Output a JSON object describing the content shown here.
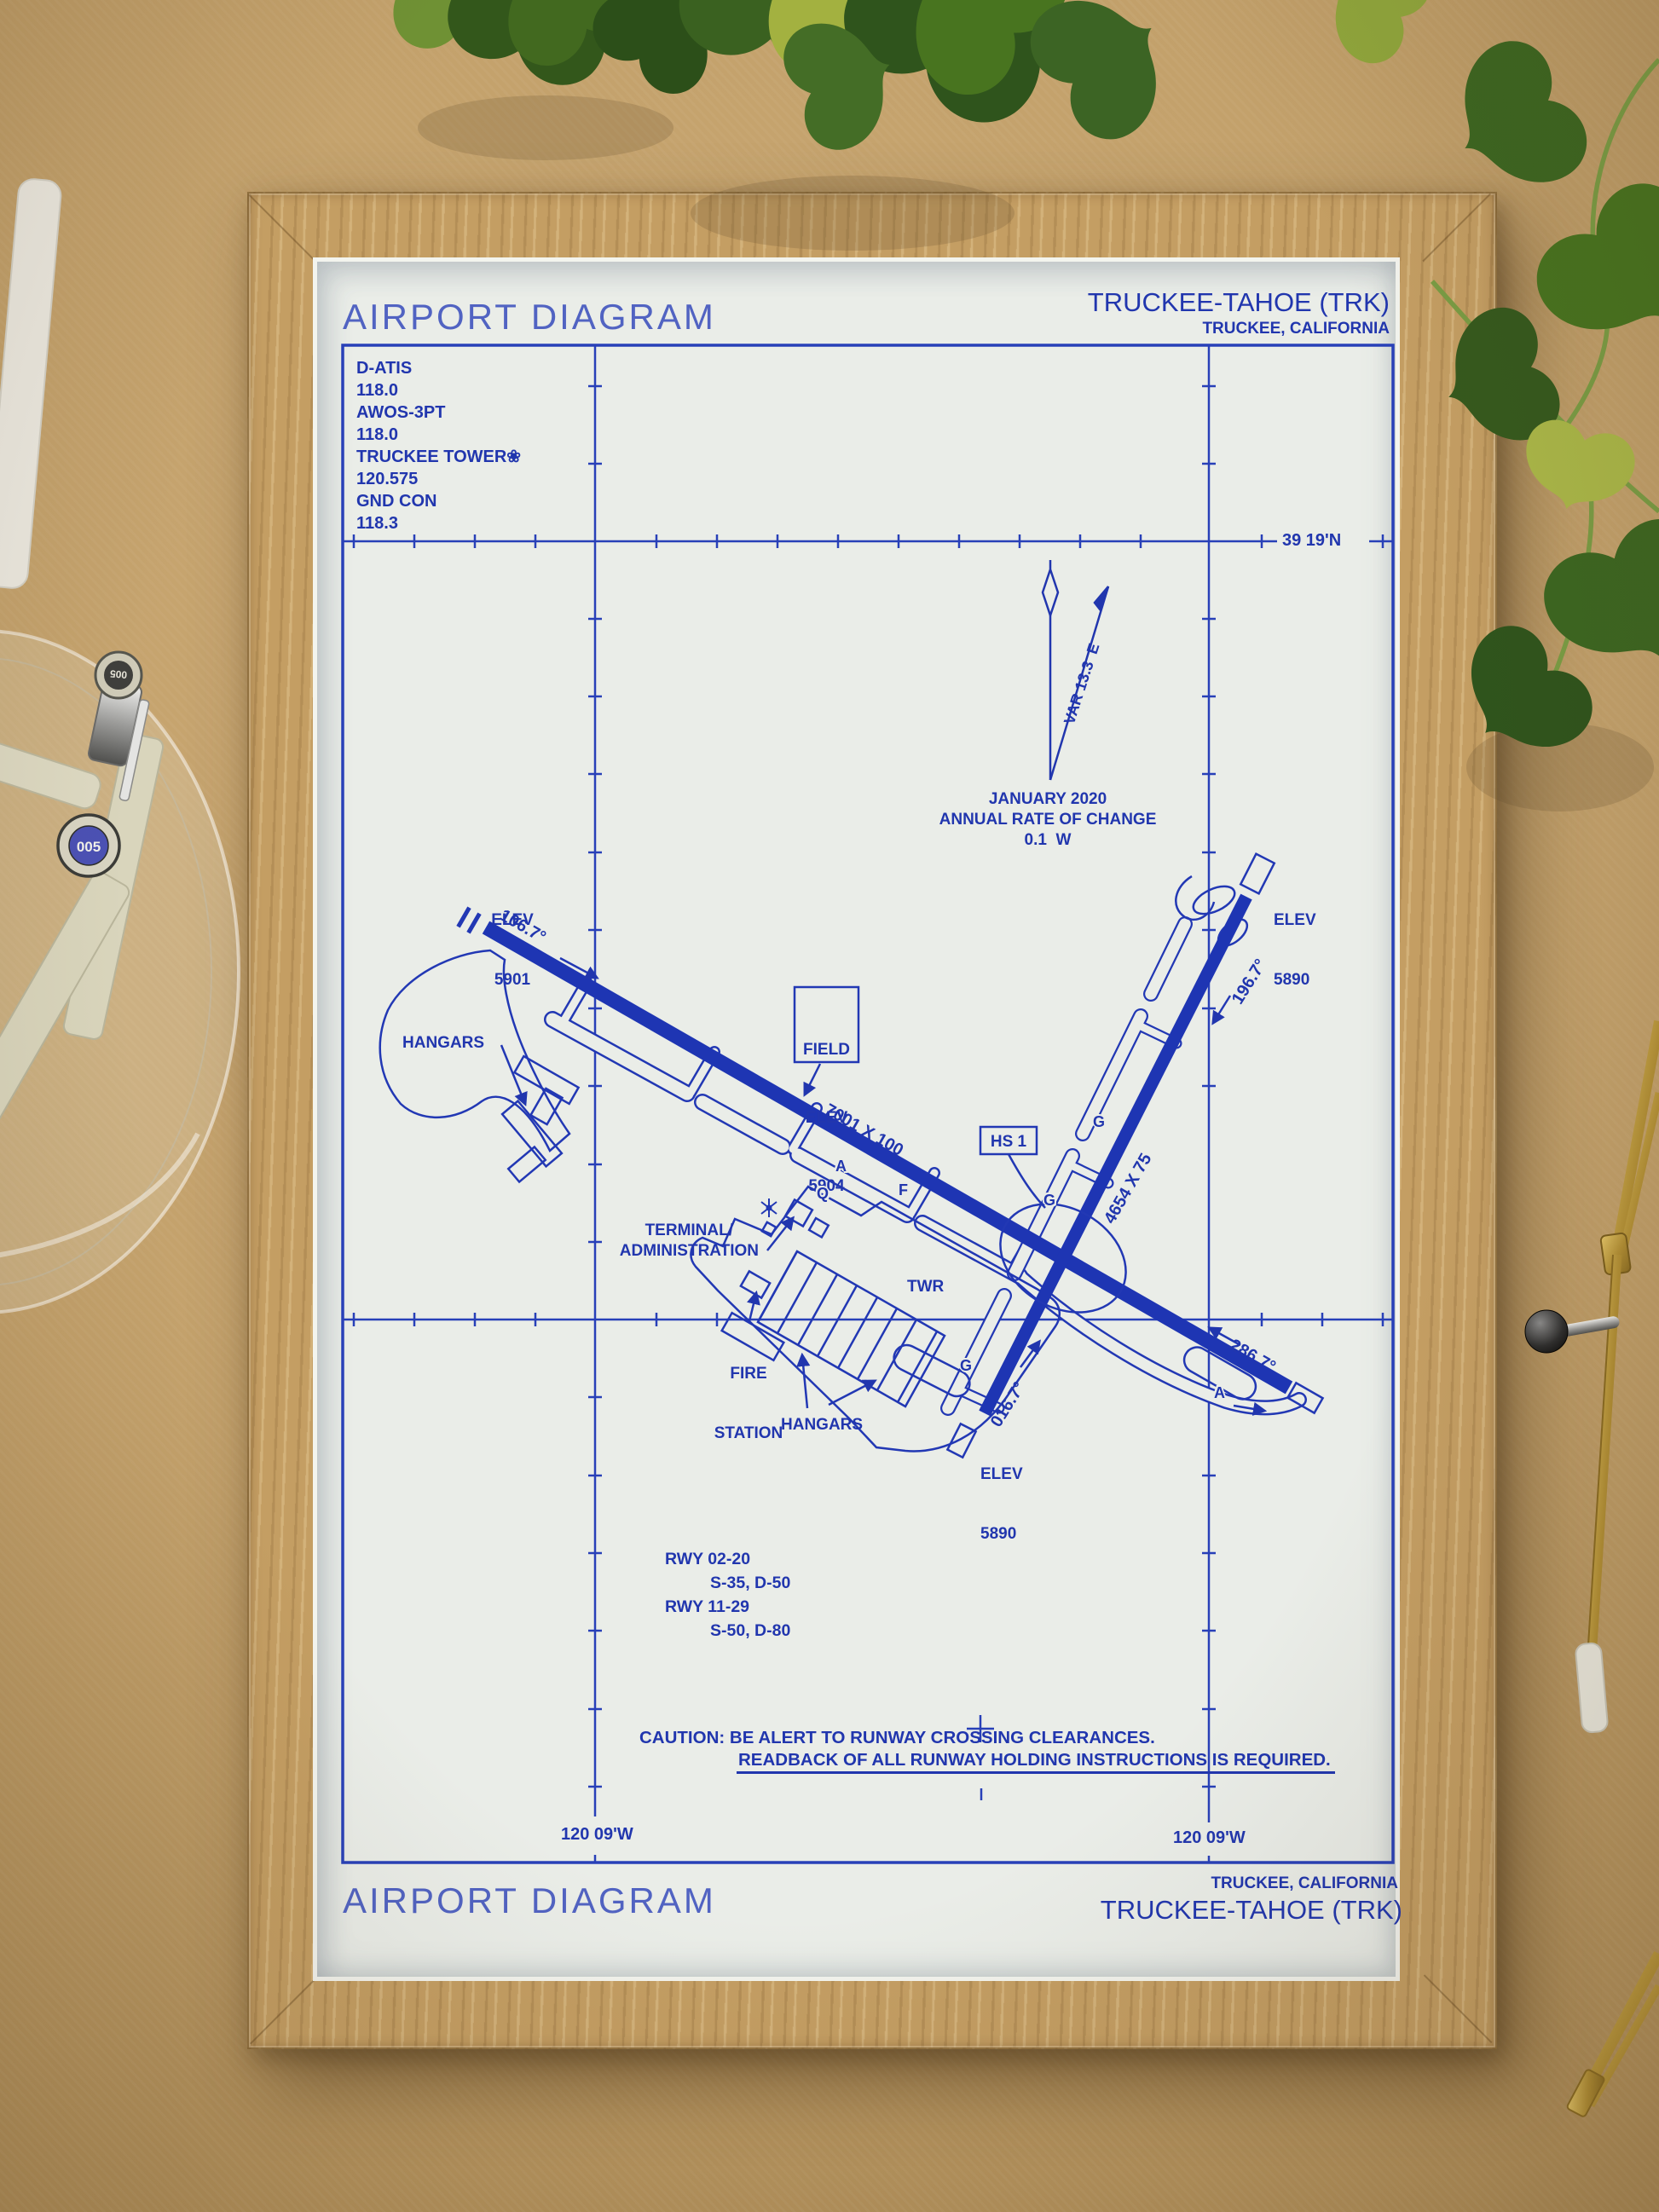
{
  "scene": {
    "colors": {
      "ink": "#2136ae",
      "ink_runway": "#1e35b3",
      "title_ink": "#5163c2",
      "paper": "#eaede8",
      "desk": "#c2a06a",
      "frame_wood": "#c49e63",
      "leaf_green": "#3a6120",
      "brass": "#b28f35"
    }
  },
  "chart": {
    "header": {
      "title": "AIRPORT DIAGRAM",
      "airport_name": "TRUCKEE-TAHOE (TRK)",
      "airport_city": "TRUCKEE, CALIFORNIA"
    },
    "comm_box": {
      "lines": [
        "D-ATIS",
        "118.0",
        "AWOS-3PT",
        "118.0",
        "TRUCKEE TOWER❀",
        "120.575",
        "GND CON",
        "118.3"
      ]
    },
    "graticule": {
      "lat_label": "39 19'N",
      "lon_label_left": "120 09'W",
      "lon_label_right": "120 09'W"
    },
    "north": {
      "var_label": "VAR 13.3  E",
      "note1": "JANUARY 2020",
      "note2": "ANNUAL RATE OF CHANGE",
      "note3": "0.1  W"
    },
    "field_elev": {
      "lines": [
        "FIELD",
        "ELEV",
        "5904"
      ]
    },
    "hot_spot": "HS 1",
    "elevations": {
      "rwy11": [
        "ELEV",
        "5901"
      ],
      "rwy20": [
        "ELEV",
        "5890"
      ],
      "rwy02": [
        "ELEV",
        "5890"
      ]
    },
    "runways": {
      "rwy_11_29": {
        "size_label": "7001 X 100",
        "hdg_11": "106.7°",
        "hdg_29": "286.7°"
      },
      "rwy_02_20": {
        "size_label": "4654 X 75",
        "hdg_02": "016.7°",
        "hdg_20": "196.7°"
      }
    },
    "facilities": {
      "hangars_west": "HANGARS",
      "hangars_south": "HANGARS",
      "terminal_line1": "TERMINAL/",
      "terminal_line2": "ADMINISTRATION",
      "fire_line1": "FIRE",
      "fire_line2": "STATION",
      "tower": "TWR"
    },
    "taxiway_labels": [
      "A",
      "Q",
      "F",
      "G",
      "G",
      "G",
      "A"
    ],
    "runway_data_lines": [
      "RWY 02-20",
      "S-35, D-50",
      "RWY 11-29",
      "S-50, D-80"
    ],
    "caution": {
      "line1": "CAUTION: BE ALERT TO RUNWAY CROSSING CLEARANCES.",
      "line2": "READBACK OF ALL RUNWAY HOLDING INSTRUCTIONS IS REQUIRED."
    },
    "footer": {
      "city": "TRUCKEE, CALIFORNIA",
      "airport_name": "TRUCKEE-TAHOE (TRK)",
      "title": "AIRPORT DIAGRAM"
    }
  },
  "desk_items": {
    "pen_cap_label_1": "005",
    "pen_cap_label_2": "005"
  }
}
